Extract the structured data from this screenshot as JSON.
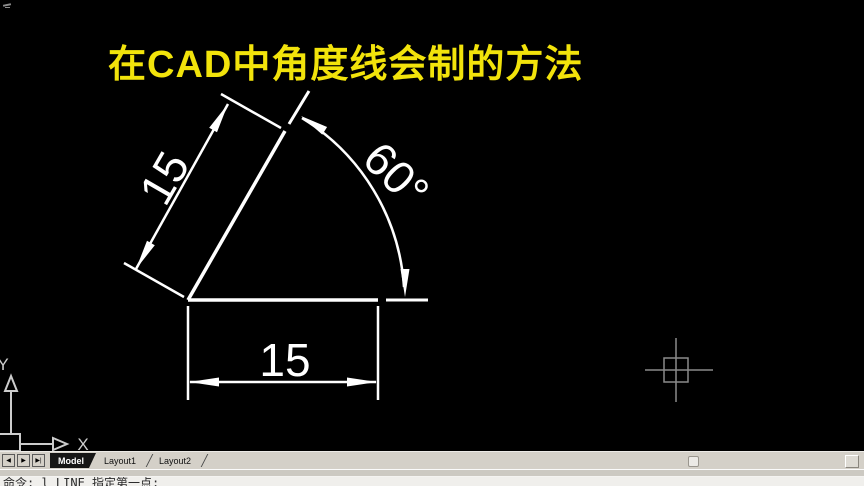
{
  "title": {
    "text": "在CAD中角度线会制的方法"
  },
  "colors": {
    "title_yellow": "#f2e30b",
    "drawing_line": "#ffffff",
    "crosshair_gray": "#8a8a8a",
    "ucs_gray": "#cccccc",
    "tabbar_gray": "#d4d0c8"
  },
  "drawing": {
    "aligned_dim_label": "15",
    "horizontal_dim_label": "15",
    "angle_dim_label": "60°"
  },
  "ucs": {
    "x_label": "X",
    "y_label": "Y"
  },
  "tab_bar": {
    "nav_buttons": [
      {
        "label": "◀"
      },
      {
        "label": "▶"
      },
      {
        "label": "▶|"
      }
    ],
    "tabs": [
      {
        "label": "Model",
        "active": true
      },
      {
        "label": "Layout1",
        "active": false
      },
      {
        "label": "Layout2",
        "active": false
      }
    ]
  },
  "command_line": {
    "text": "命令: l LINE 指定第一点:"
  }
}
